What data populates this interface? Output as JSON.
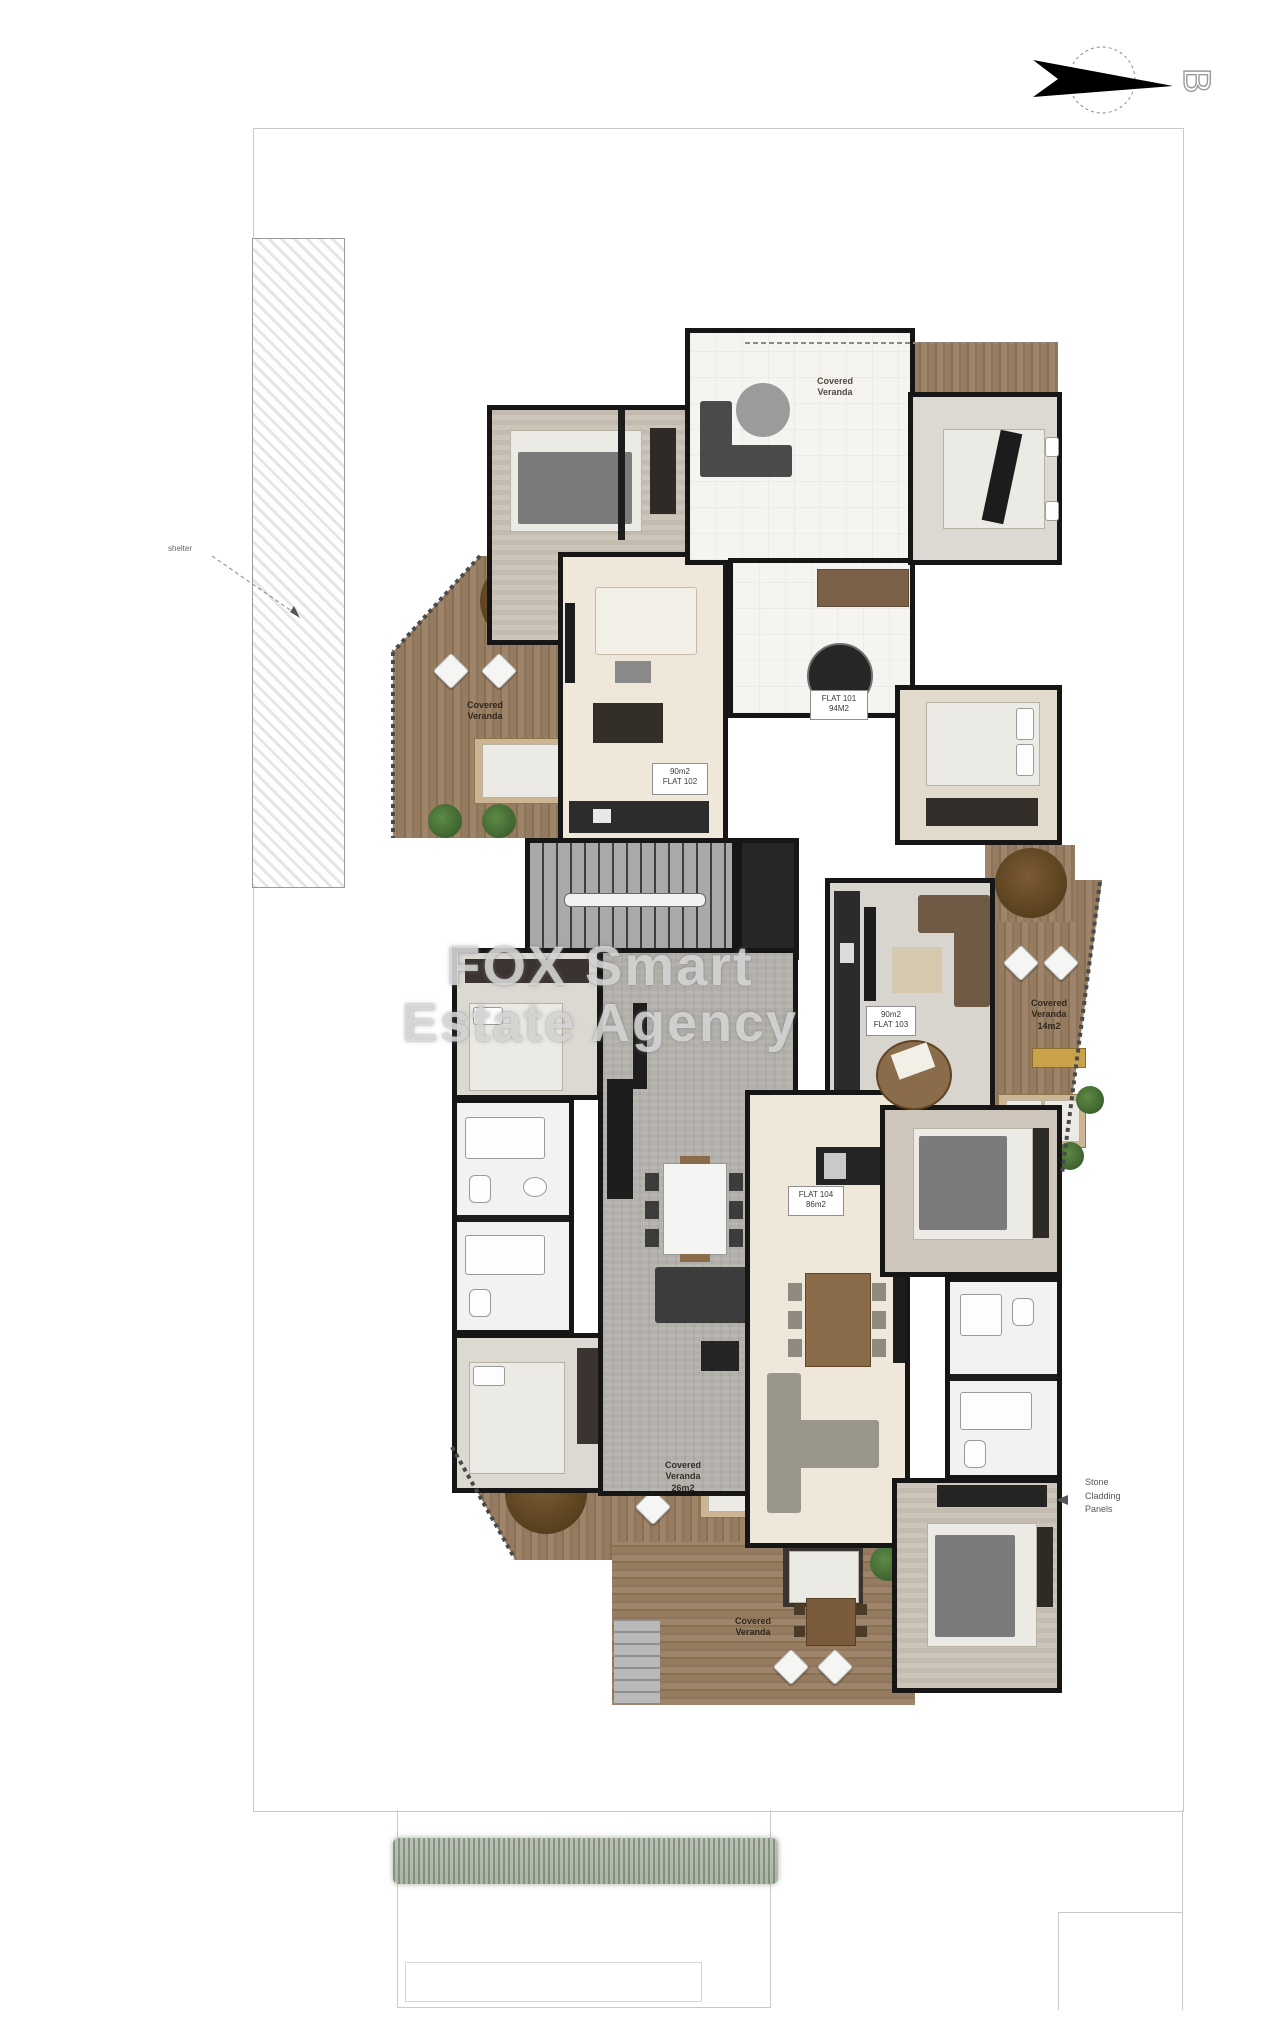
{
  "compass": {
    "letter": "B"
  },
  "watermark": {
    "line1": "FOX Smart",
    "line2": "Estate Agency"
  },
  "site": {
    "shelter_label": "shelter",
    "stone_cladding": {
      "line1": "Stone",
      "line2": "Cladding",
      "line3": "Panels"
    }
  },
  "flats": {
    "flat_top": {
      "line1": "FLAT 101",
      "line2": "94M2"
    },
    "flat_left": {
      "line1": "90m2",
      "line2": "FLAT 102"
    },
    "flat_right": {
      "line1": "90m2",
      "line2": "FLAT 103"
    },
    "flat_bottom": {
      "line1": "FLAT 104",
      "line2": "86m2"
    }
  },
  "verandas": {
    "top": {
      "line1": "Covered",
      "line2": "Veranda",
      "line3": ""
    },
    "left": {
      "line1": "Covered",
      "line2": "Veranda",
      "line3": ""
    },
    "right": {
      "line1": "Covered",
      "line2": "Veranda",
      "line3": "14m2"
    },
    "bottom_left": {
      "line1": "Covered",
      "line2": "Veranda",
      "line3": "26m2"
    },
    "bottom_center": {
      "line1": "Covered",
      "line2": "Veranda",
      "line3": ""
    }
  },
  "colors": {
    "wall": "#161616",
    "wood_deck": "#977d60",
    "cream_floor": "#efe8da",
    "concrete_floor": "#b3b0ab",
    "plant_green": "#4e7a3a",
    "boundary_line": "#c9c9c9"
  }
}
